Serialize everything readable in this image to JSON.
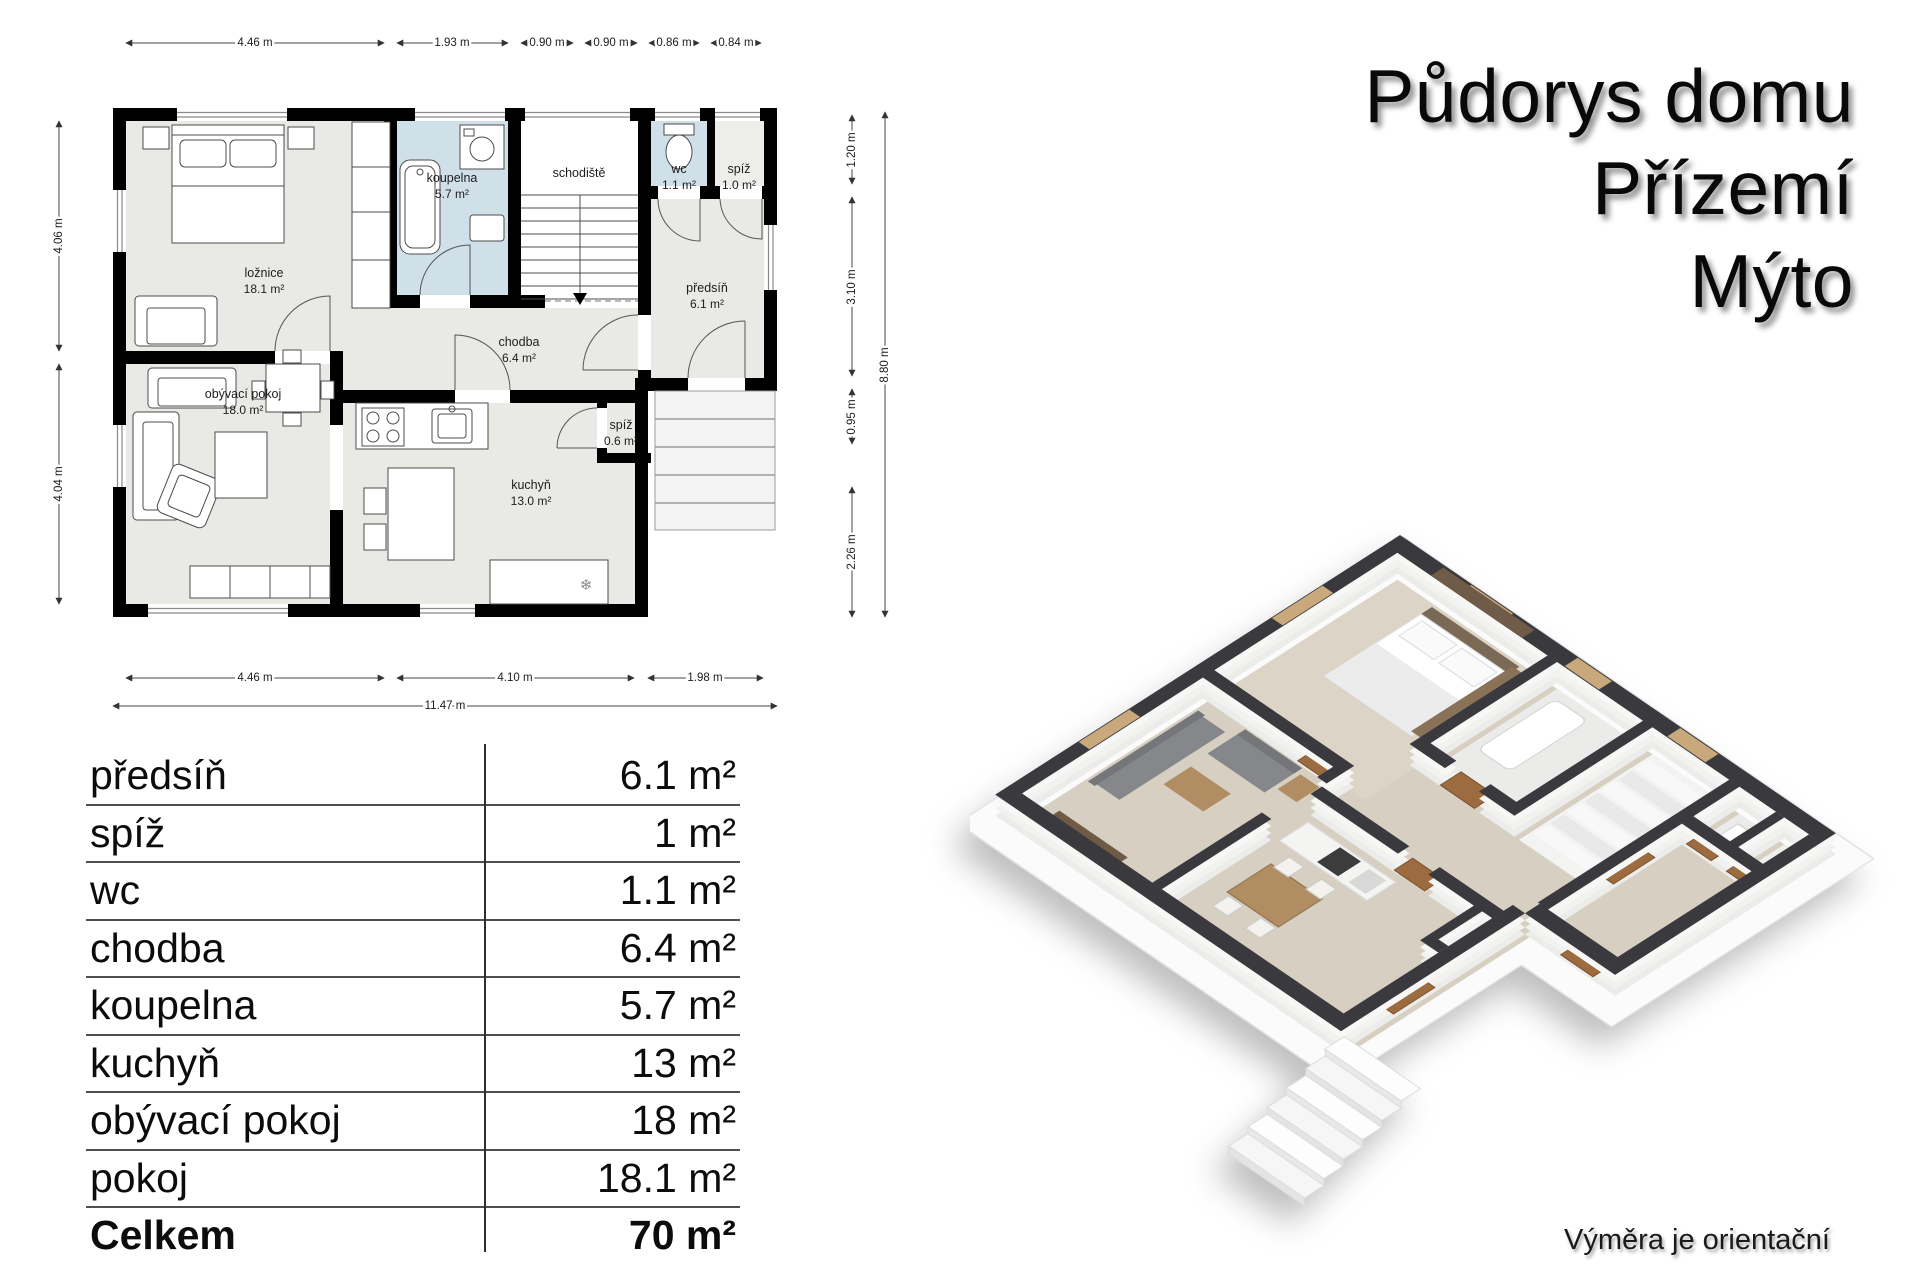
{
  "title": {
    "lines": [
      "Půdorys domu",
      "Přízemí",
      "Mýto"
    ]
  },
  "caption": "Výměra je orientační",
  "colors": {
    "wall_black": "#000000",
    "floor_gray": "#e9e9e5",
    "wet_room_blue": "#cfe0e9",
    "iso_wall_top": "#3a3a3e",
    "iso_floor_beige": "#d7cfc1",
    "iso_wood_door": "#9c6b3f"
  },
  "floor_plan_2d": {
    "rooms": {
      "loznice": {
        "name": "ložnice",
        "area": "18.1 m²"
      },
      "koupelna": {
        "name": "koupelna",
        "area": "5.7 m²"
      },
      "schodiste": {
        "name": "schodiště"
      },
      "wc": {
        "name": "wc",
        "area": "1.1 m²"
      },
      "spiz_horni": {
        "name": "spíž",
        "area": "1.0 m²"
      },
      "predsin": {
        "name": "předsíň",
        "area": "6.1 m²"
      },
      "chodba": {
        "name": "chodba",
        "area": "6.4 m²"
      },
      "spiz_mala": {
        "name": "spíž",
        "area": "0.6 m²"
      },
      "kuchyn": {
        "name": "kuchyň",
        "area": "13.0 m²"
      },
      "obyvaci": {
        "name": "obývací pokoj",
        "area": "18.0 m²"
      }
    },
    "dimensions": {
      "top": [
        "4.46 m",
        "1.93 m",
        "0.90 m",
        "0.90 m",
        "0.86 m",
        "0.84 m"
      ],
      "bottom": [
        "4.46 m",
        "4.10 m",
        "1.98 m"
      ],
      "bottom_total": "11.47 m",
      "left": [
        "4.06 m",
        "4.04 m"
      ],
      "right": [
        "1.20 m",
        "3.10 m",
        "0.95 m",
        "2.26 m"
      ],
      "right_total": "8.80 m"
    }
  },
  "area_table": {
    "rows": [
      {
        "label": "předsíň",
        "value": "6.1 m²"
      },
      {
        "label": "spíž",
        "value": "1 m²"
      },
      {
        "label": "wc",
        "value": "1.1 m²"
      },
      {
        "label": "chodba",
        "value": "6.4 m²"
      },
      {
        "label": "koupelna",
        "value": "5.7 m²"
      },
      {
        "label": "kuchyň",
        "value": "13 m²"
      },
      {
        "label": "obývací pokoj",
        "value": "18 m²"
      },
      {
        "label": "pokoj",
        "value": "18.1 m²"
      }
    ],
    "total": {
      "label": "Celkem",
      "value": "70 m²"
    }
  }
}
